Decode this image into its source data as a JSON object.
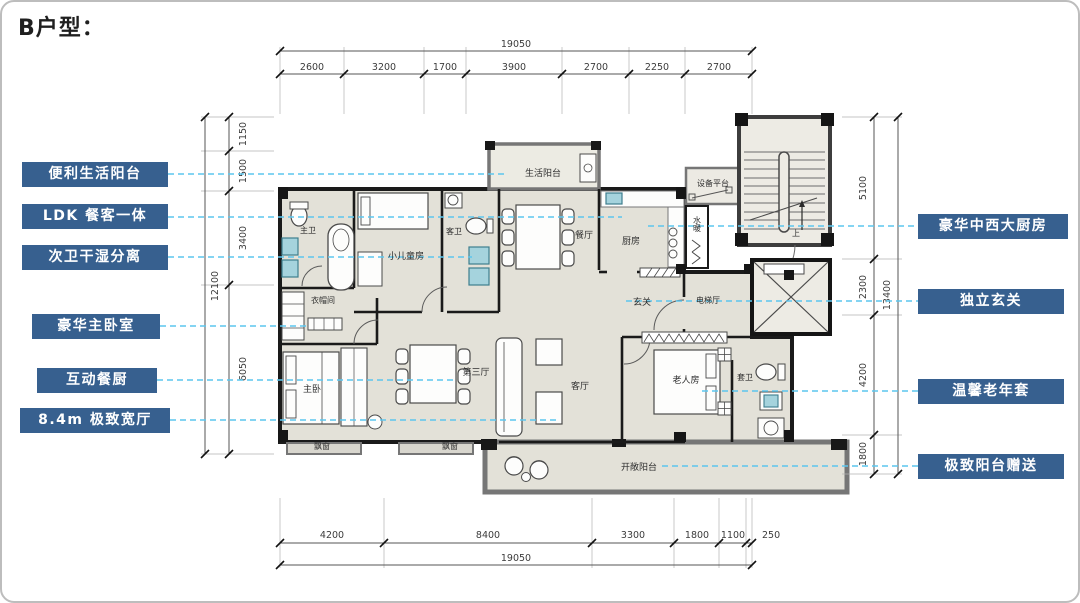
{
  "title": "B户型：",
  "colors": {
    "feature_box_bg": "#37608f",
    "leader_dash": "#5cc6ee",
    "wall": "#1a1a1a",
    "room_fill": "#e3e1d8",
    "fixture_teal": "#a5d3dd"
  },
  "features_left": [
    {
      "label": "便利生活阳台"
    },
    {
      "label": "LDK 餐客一体"
    },
    {
      "label": "次卫干湿分离"
    },
    {
      "label": "豪华主卧室"
    },
    {
      "label": "互动餐厨"
    },
    {
      "label": "8.4m 极致宽厅"
    }
  ],
  "features_right": [
    {
      "label": "豪华中西大厨房"
    },
    {
      "label": "独立玄关"
    },
    {
      "label": "温馨老年套"
    },
    {
      "label": "极致阳台赠送"
    }
  ],
  "dimensions": {
    "top": {
      "total": "19050",
      "segments": [
        "2600",
        "3200",
        "1700",
        "3900",
        "2700",
        "2250",
        "2700"
      ]
    },
    "bottom": {
      "total": "19050",
      "segments": [
        "4200",
        "8400",
        "3300",
        "1800",
        "1100",
        "250"
      ]
    },
    "left": {
      "total": "12100",
      "segments": [
        "1150",
        "1500",
        "3400",
        "6050"
      ]
    },
    "right": {
      "total": "13400",
      "segments": [
        "5100",
        "2300",
        "4200",
        "1800"
      ]
    }
  },
  "rooms": [
    {
      "name": "living-balcony",
      "label": "生活阳台"
    },
    {
      "name": "master-bath",
      "label": "主卫"
    },
    {
      "name": "kids-room",
      "label": "小儿童房"
    },
    {
      "name": "guest-bath",
      "label": "客卫"
    },
    {
      "name": "dining-room",
      "label": "餐厅"
    },
    {
      "name": "kitchen",
      "label": "厨房"
    },
    {
      "name": "plumbing-shaft",
      "label": "水暖"
    },
    {
      "name": "equipment-platform",
      "label": "设备平台"
    },
    {
      "name": "foyer",
      "label": "玄关"
    },
    {
      "name": "elevator-hall",
      "label": "电梯厅"
    },
    {
      "name": "cloakroom",
      "label": "衣帽间"
    },
    {
      "name": "master-bedroom",
      "label": "主卧"
    },
    {
      "name": "third-hall",
      "label": "第三厅"
    },
    {
      "name": "living-room",
      "label": "客厅"
    },
    {
      "name": "elderly-room",
      "label": "老人房"
    },
    {
      "name": "suite-bath",
      "label": "套卫"
    },
    {
      "name": "bay-window-left",
      "label": "飘窗"
    },
    {
      "name": "bay-window-right",
      "label": "飘窗"
    },
    {
      "name": "open-balcony",
      "label": "开敞阳台"
    },
    {
      "name": "stairs-up",
      "label": "上"
    }
  ]
}
